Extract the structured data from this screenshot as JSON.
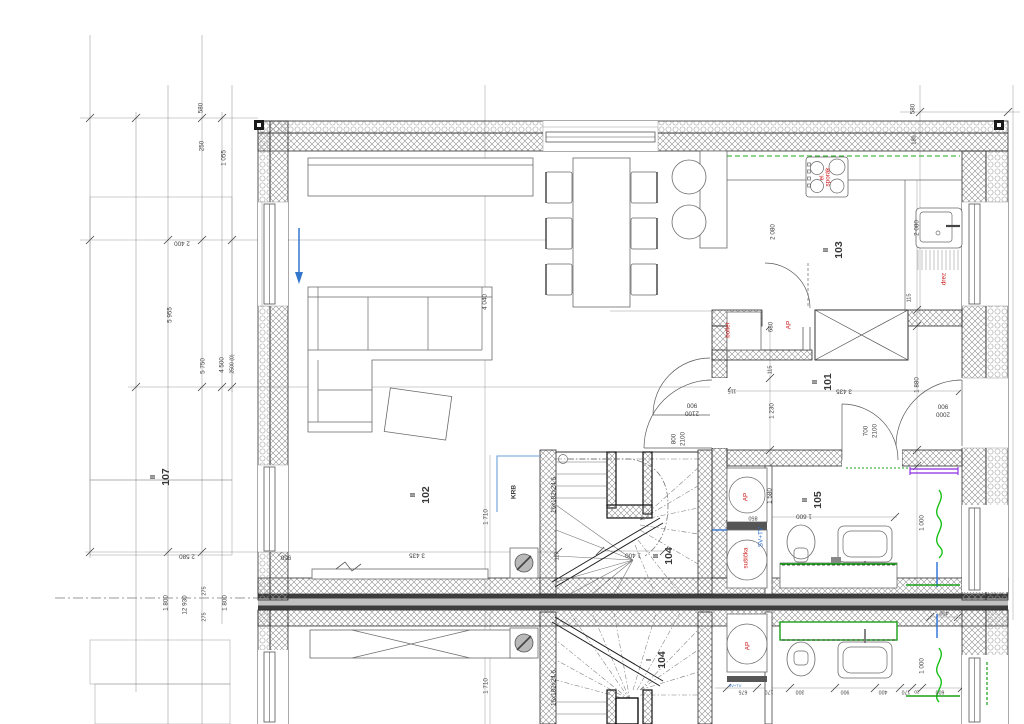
{
  "drawing": {
    "type": "architectural floor plan, two mirrored dwelling units",
    "scale_note": "dimensions in millimetres"
  },
  "colors": {
    "dim": "#3d3d3d",
    "label": "#383838",
    "red": "#cc2020",
    "blue": "#2b6fd4",
    "green": "#1aa31a",
    "purple": "#8a2be2",
    "wall_dark": "#3d3d3d"
  },
  "rooms": [
    {
      "unit": "II",
      "number": "102",
      "x": 420,
      "y": 495
    },
    {
      "unit": "II",
      "number": "103",
      "x": 833,
      "y": 250
    },
    {
      "unit": "II",
      "number": "101",
      "x": 822,
      "y": 382
    },
    {
      "unit": "II",
      "number": "104",
      "x": 663,
      "y": 556
    },
    {
      "unit": "II",
      "number": "105",
      "x": 812,
      "y": 500
    },
    {
      "unit": "II",
      "number": "107",
      "x": 160,
      "y": 477
    },
    {
      "unit": "I",
      "number": "104",
      "x": 656,
      "y": 660
    }
  ],
  "texts": [
    {
      "t": "5 955",
      "x": 170,
      "y": 315,
      "r": -90
    },
    {
      "t": "580",
      "x": 201,
      "y": 108,
      "r": -90
    },
    {
      "t": "250",
      "x": 202,
      "y": 146,
      "r": -90
    },
    {
      "t": "1 055",
      "x": 224,
      "y": 158,
      "r": -90
    },
    {
      "t": "2 400",
      "x": 182,
      "y": 243,
      "r": 180
    },
    {
      "t": "5 750",
      "x": 203,
      "y": 366,
      "r": -90
    },
    {
      "t": "4 500",
      "x": 222,
      "y": 365,
      "r": -90
    },
    {
      "t": "2500 (0)",
      "x": 232,
      "y": 364,
      "r": -90,
      "s": 5.2
    },
    {
      "t": "1 800",
      "x": 166,
      "y": 603,
      "r": -90
    },
    {
      "t": "12 930",
      "x": 185,
      "y": 605,
      "r": -90
    },
    {
      "t": "275",
      "x": 204,
      "y": 591,
      "r": -90,
      "s": 5.5
    },
    {
      "t": "275",
      "x": 204,
      "y": 617,
      "r": -90,
      "s": 5.5
    },
    {
      "t": "1 800",
      "x": 225,
      "y": 603,
      "r": -90
    },
    {
      "t": "2 580",
      "x": 187,
      "y": 556,
      "r": 180
    },
    {
      "t": "950",
      "x": 286,
      "y": 557,
      "r": 180
    },
    {
      "t": "3 435",
      "x": 417,
      "y": 555,
      "r": 180
    },
    {
      "t": "1 400",
      "x": 633,
      "y": 555,
      "r": 180
    },
    {
      "t": "117",
      "x": 557,
      "y": 556,
      "r": -90,
      "s": 5.5
    },
    {
      "t": "4 040",
      "x": 485,
      "y": 302,
      "r": -90
    },
    {
      "t": "1 710",
      "x": 486,
      "y": 517,
      "r": -90
    },
    {
      "t": "1 710",
      "x": 486,
      "y": 686,
      "r": -90
    },
    {
      "t": "3 435",
      "x": 844,
      "y": 391,
      "r": 180
    },
    {
      "t": "115",
      "x": 732,
      "y": 391,
      "r": 180,
      "s": 5.5
    },
    {
      "t": "2 080",
      "x": 773,
      "y": 232,
      "r": -90
    },
    {
      "t": "680",
      "x": 771,
      "y": 327,
      "r": -90
    },
    {
      "t": "115",
      "x": 770,
      "y": 370,
      "r": -90,
      "s": 5.5
    },
    {
      "t": "1 230",
      "x": 772,
      "y": 411,
      "r": -90
    },
    {
      "t": "1 580",
      "x": 770,
      "y": 496,
      "r": -90
    },
    {
      "t": "1 600",
      "x": 804,
      "y": 516,
      "r": 180
    },
    {
      "t": "850",
      "x": 753,
      "y": 518,
      "r": 180,
      "s": 5.5
    },
    {
      "t": "2 080",
      "x": 917,
      "y": 228,
      "r": -90
    },
    {
      "t": "115",
      "x": 909,
      "y": 298,
      "r": -90,
      "s": 5.5
    },
    {
      "t": "580",
      "x": 913,
      "y": 109,
      "r": -90
    },
    {
      "t": "180",
      "x": 914,
      "y": 140,
      "r": -90,
      "s": 5.5
    },
    {
      "t": "1 880",
      "x": 917,
      "y": 385,
      "r": -90
    },
    {
      "t": "700",
      "x": 866,
      "y": 431,
      "r": -90,
      "n": "door-size-label"
    },
    {
      "t": "2100",
      "x": 875,
      "y": 431,
      "r": -90,
      "n": "door-size-label"
    },
    {
      "t": "800",
      "x": 674,
      "y": 439,
      "r": -90,
      "n": "door-size-label"
    },
    {
      "t": "2100",
      "x": 683,
      "y": 439,
      "r": -90,
      "n": "door-size-label"
    },
    {
      "t": "900",
      "x": 692,
      "y": 405,
      "r": 180,
      "n": "door-size-label"
    },
    {
      "t": "2100",
      "x": 692,
      "y": 413,
      "r": 180,
      "n": "door-size-label"
    },
    {
      "t": "900",
      "x": 943,
      "y": 406,
      "r": 180,
      "n": "door-size-label"
    },
    {
      "t": "2000",
      "x": 943,
      "y": 414,
      "r": 180,
      "n": "door-size-label"
    },
    {
      "t": "1 000",
      "x": 922,
      "y": 523,
      "r": -90
    },
    {
      "t": "1 000",
      "x": 922,
      "y": 666,
      "r": -90
    },
    {
      "t": "400",
      "x": 944,
      "y": 613,
      "r": 180,
      "s": 5.5
    },
    {
      "t": "675",
      "x": 743,
      "y": 692,
      "r": 180,
      "s": 5.2
    },
    {
      "t": "170",
      "x": 769,
      "y": 692,
      "r": 180,
      "s": 5.2
    },
    {
      "t": "300",
      "x": 800,
      "y": 692,
      "r": 180,
      "s": 5.2
    },
    {
      "t": "900",
      "x": 845,
      "y": 692,
      "r": 180,
      "s": 5.2
    },
    {
      "t": "400",
      "x": 883,
      "y": 692,
      "r": 180,
      "s": 5.2
    },
    {
      "t": "170",
      "x": 906,
      "y": 692,
      "r": 180,
      "s": 5.2
    },
    {
      "t": "20",
      "x": 917,
      "y": 692,
      "r": 180,
      "s": 4.8
    },
    {
      "t": "600",
      "x": 940,
      "y": 692,
      "r": 180,
      "s": 5.2
    },
    {
      "t": "16x182x24,6",
      "x": 554,
      "y": 495,
      "r": -90,
      "n": "stair-spec-label"
    },
    {
      "t": "16x182x24,6",
      "x": 554,
      "y": 688,
      "r": -90,
      "n": "stair-spec-label"
    },
    {
      "t": "KRB",
      "x": 514,
      "y": 492,
      "r": -90,
      "s": 6.5,
      "w": "bold",
      "n": "fireplace-label"
    },
    {
      "t": "el.",
      "x": 822,
      "y": 177,
      "r": -90,
      "c": "red",
      "n": "appliance-label"
    },
    {
      "t": "sporák",
      "x": 828,
      "y": 177,
      "r": -90,
      "c": "red",
      "n": "appliance-label"
    },
    {
      "t": "drez",
      "x": 944,
      "y": 279,
      "r": -90,
      "c": "red",
      "n": "appliance-label"
    },
    {
      "t": "boiler",
      "x": 728,
      "y": 330,
      "r": -90,
      "c": "red",
      "n": "appliance-label"
    },
    {
      "t": "AP",
      "x": 789,
      "y": 325,
      "r": -90,
      "c": "red",
      "n": "appliance-label"
    },
    {
      "t": "AP",
      "x": 746,
      "y": 497,
      "r": -90,
      "c": "red",
      "n": "appliance-label"
    },
    {
      "t": "sušička",
      "x": 746,
      "y": 558,
      "r": -90,
      "c": "red",
      "n": "appliance-label"
    },
    {
      "t": "AP",
      "x": 748,
      "y": 646,
      "r": -90,
      "c": "red",
      "n": "appliance-label"
    },
    {
      "t": "SV+TV",
      "x": 761,
      "y": 537,
      "r": -90,
      "c": "blue",
      "n": "plumbing-label"
    },
    {
      "t": "SV+TV",
      "x": 735,
      "y": 686,
      "r": 0,
      "c": "blue",
      "s": 4,
      "n": "plumbing-label"
    }
  ]
}
